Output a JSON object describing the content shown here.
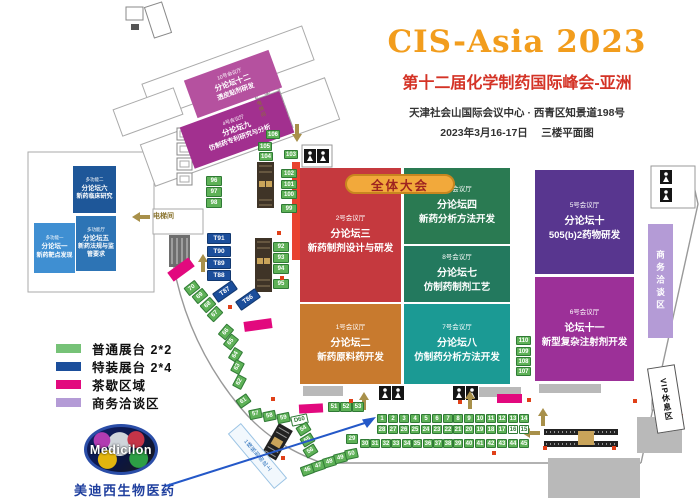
{
  "title": {
    "brand": "CIS-Asia 2023",
    "subtitle": "第十二届化学制药国际峰会-亚洲",
    "venue": "天津社会山国际会议中心 · 西青区知景道198号",
    "dateline": "2023年3月16-17日　 三楼平面图"
  },
  "banner": {
    "label": "全体大会"
  },
  "legend": {
    "items": [
      {
        "label": "普通展台 2*2",
        "color": "#76c277"
      },
      {
        "label": "特装展台 2*4",
        "color": "#1b4e9b"
      },
      {
        "label": "茶歇区域",
        "color": "#e2097e"
      },
      {
        "label": "商务洽谈区",
        "color": "#b49bd6"
      }
    ]
  },
  "areas": {
    "business": "商务洽谈区",
    "vip": "VIP休息区",
    "elevator": "电梯间",
    "registration": "1楼报到由此上"
  },
  "sponsor": {
    "name": "Medicilon",
    "cn_name": "美迪西生物医药"
  },
  "map": {
    "colors": {
      "booth_standard": "#5eb157",
      "booth_special": "#1b4e9b",
      "tea_break": "#e2097e",
      "business_area": "#b49bd6",
      "red_strip": "#e8432f"
    },
    "halls": [
      {
        "room": "2号会议厅",
        "forum": "分论坛三",
        "topic": "新药制剂设计与研发",
        "color": "#c5393e",
        "x": 300,
        "y": 168,
        "w": 101,
        "h": 134,
        "fs": "lg"
      },
      {
        "room": "1号会议厅",
        "forum": "分论坛二",
        "topic": "新药原料药开发",
        "color": "#c87a2e",
        "x": 300,
        "y": 304,
        "w": 101,
        "h": 80,
        "fs": "lg"
      },
      {
        "room": "3号会议厅",
        "forum": "分论坛四",
        "topic": "新药分析方法开发",
        "color": "#2a7a52",
        "x": 404,
        "y": 168,
        "w": 106,
        "h": 76,
        "fs": "lg"
      },
      {
        "room": "8号会议厅",
        "forum": "分论坛七",
        "topic": "仿制药制剂工艺",
        "color": "#23795e",
        "x": 404,
        "y": 246,
        "w": 106,
        "h": 56,
        "fs": "lg"
      },
      {
        "room": "7号会议厅",
        "forum": "分论坛八",
        "topic": "仿制药分析方法开发",
        "color": "#1b9a94",
        "x": 404,
        "y": 304,
        "w": 106,
        "h": 80,
        "fs": "lg"
      },
      {
        "room": "5号会议厅",
        "forum": "分论坛十",
        "topic": "505(b)2药物研发",
        "color": "#58368f",
        "x": 535,
        "y": 170,
        "w": 99,
        "h": 104,
        "fs": "lg"
      },
      {
        "room": "6号会议厅",
        "forum": "论坛十一",
        "topic": "新型复杂注射剂开发",
        "color": "#9c3098",
        "x": 535,
        "y": 277,
        "w": 99,
        "h": 104,
        "fs": "lg"
      },
      {
        "room": "多功能二",
        "forum": "分论坛六",
        "topic": "新药临床研究",
        "color": "#1e5799",
        "x": 73,
        "y": 166,
        "w": 43,
        "h": 47,
        "fs": "sm"
      },
      {
        "room": "多功能厅",
        "forum": "分论坛五",
        "topic": "新药法规与监管要求",
        "color": "#2d74b5",
        "x": 76,
        "y": 216,
        "w": 40,
        "h": 55,
        "fs": "sm"
      },
      {
        "room": "多功能一",
        "forum": "分论坛一",
        "topic": "新药靶点发现",
        "color": "#3f8fd2",
        "x": 34,
        "y": 223,
        "w": 41,
        "h": 50,
        "fs": "sm"
      },
      {
        "room": "10号会议厅",
        "forum": "分论坛十二",
        "topic": "透皮贴剂研发",
        "color": "#b5519f",
        "x": 188,
        "y": 64,
        "w": 90,
        "h": 40,
        "r": -20,
        "fs": "xs"
      },
      {
        "room": "4号会议厅",
        "forum": "分论坛九",
        "topic": "仿制药专利研究与分析",
        "color": "#a2308f",
        "x": 184,
        "y": 108,
        "w": 106,
        "h": 44,
        "r": -20,
        "fs": "xs"
      }
    ],
    "booths": [
      {
        "label": "106",
        "x": 266,
        "y": 130,
        "w": 14,
        "h": 9
      },
      {
        "label": "105",
        "x": 258,
        "y": 142,
        "w": 14,
        "h": 9
      },
      {
        "label": "104",
        "x": 259,
        "y": 152,
        "w": 14,
        "h": 9
      },
      {
        "label": "103",
        "x": 284,
        "y": 150,
        "w": 14,
        "h": 9
      },
      {
        "label": "96",
        "x": 206,
        "y": 176,
        "w": 16,
        "h": 10
      },
      {
        "label": "97",
        "x": 206,
        "y": 187,
        "w": 16,
        "h": 10
      },
      {
        "label": "98",
        "x": 206,
        "y": 198,
        "w": 16,
        "h": 10
      },
      {
        "label": "102",
        "x": 281,
        "y": 169,
        "w": 16,
        "h": 9
      },
      {
        "label": "101",
        "x": 281,
        "y": 180,
        "w": 16,
        "h": 9
      },
      {
        "label": "100",
        "x": 281,
        "y": 190,
        "w": 16,
        "h": 9
      },
      {
        "label": "99",
        "x": 281,
        "y": 204,
        "w": 16,
        "h": 9
      },
      {
        "label": "110",
        "x": 516,
        "y": 336,
        "w": 15,
        "h": 9
      },
      {
        "label": "109",
        "x": 516,
        "y": 347,
        "w": 15,
        "h": 9
      },
      {
        "label": "108",
        "x": 516,
        "y": 357,
        "w": 15,
        "h": 9
      },
      {
        "label": "107",
        "x": 516,
        "y": 367,
        "w": 15,
        "h": 9
      },
      {
        "label": "T91",
        "x": 207,
        "y": 233,
        "w": 24,
        "h": 11,
        "k": "sp"
      },
      {
        "label": "T90",
        "x": 207,
        "y": 246,
        "w": 24,
        "h": 11,
        "k": "sp"
      },
      {
        "label": "T89",
        "x": 207,
        "y": 258,
        "w": 24,
        "h": 11,
        "k": "sp"
      },
      {
        "label": "T88",
        "x": 207,
        "y": 270,
        "w": 24,
        "h": 11,
        "k": "sp"
      },
      {
        "label": "T87",
        "x": 213,
        "y": 286,
        "w": 24,
        "h": 11,
        "r": -35,
        "k": "sp"
      },
      {
        "label": "T86",
        "x": 236,
        "y": 294,
        "w": 24,
        "h": 11,
        "r": -35,
        "k": "sp"
      },
      {
        "label": "92",
        "x": 273,
        "y": 242,
        "w": 16,
        "h": 10
      },
      {
        "label": "93",
        "x": 273,
        "y": 253,
        "w": 16,
        "h": 10
      },
      {
        "label": "94",
        "x": 273,
        "y": 264,
        "w": 16,
        "h": 10
      },
      {
        "label": "95",
        "x": 273,
        "y": 279,
        "w": 16,
        "h": 10
      },
      {
        "label": "70",
        "x": 185,
        "y": 283,
        "w": 14,
        "h": 10,
        "r": -38
      },
      {
        "label": "69",
        "x": 193,
        "y": 291,
        "w": 14,
        "h": 10,
        "r": -40
      },
      {
        "label": "68",
        "x": 201,
        "y": 300,
        "w": 14,
        "h": 10,
        "r": -42
      },
      {
        "label": "67",
        "x": 208,
        "y": 309,
        "w": 14,
        "h": 10,
        "r": -45
      },
      {
        "label": "66",
        "x": 219,
        "y": 327,
        "w": 14,
        "h": 10,
        "r": -50
      },
      {
        "label": "65",
        "x": 224,
        "y": 337,
        "w": 14,
        "h": 10,
        "r": -52
      },
      {
        "label": "64",
        "x": 229,
        "y": 350,
        "w": 13,
        "h": 10,
        "r": -58
      },
      {
        "label": "63",
        "x": 231,
        "y": 362,
        "w": 13,
        "h": 10,
        "r": -62
      },
      {
        "label": "62",
        "x": 233,
        "y": 377,
        "w": 13,
        "h": 10,
        "r": -62
      },
      {
        "label": "61",
        "x": 237,
        "y": 396,
        "w": 13,
        "h": 10,
        "r": -35
      },
      {
        "label": "57",
        "x": 249,
        "y": 409,
        "w": 13,
        "h": 10,
        "r": -12
      },
      {
        "label": "58",
        "x": 263,
        "y": 411,
        "w": 13,
        "h": 10,
        "r": -12
      },
      {
        "label": "59",
        "x": 277,
        "y": 413,
        "w": 13,
        "h": 10,
        "r": -12
      },
      {
        "label": "D60",
        "x": 291,
        "y": 415,
        "w": 17,
        "h": 10,
        "r": -12,
        "k": "out"
      },
      {
        "label": "54",
        "x": 297,
        "y": 424,
        "w": 13,
        "h": 10,
        "r": -32
      },
      {
        "label": "55",
        "x": 301,
        "y": 435,
        "w": 13,
        "h": 10,
        "r": -32
      },
      {
        "label": "56",
        "x": 304,
        "y": 446,
        "w": 13,
        "h": 10,
        "r": -32
      },
      {
        "label": "46",
        "x": 301,
        "y": 465,
        "w": 13,
        "h": 10,
        "r": -20
      },
      {
        "label": "47",
        "x": 312,
        "y": 461,
        "w": 13,
        "h": 10,
        "r": -18
      },
      {
        "label": "48",
        "x": 323,
        "y": 457,
        "w": 13,
        "h": 10,
        "r": -16
      },
      {
        "label": "49",
        "x": 334,
        "y": 453,
        "w": 13,
        "h": 10,
        "r": -14
      },
      {
        "label": "50",
        "x": 345,
        "y": 449,
        "w": 13,
        "h": 10,
        "r": -12
      },
      {
        "label": "51",
        "x": 328,
        "y": 402,
        "w": 12,
        "h": 10
      },
      {
        "label": "52",
        "x": 340,
        "y": 402,
        "w": 12,
        "h": 10
      },
      {
        "label": "53",
        "x": 352,
        "y": 402,
        "w": 12,
        "h": 10
      },
      {
        "label": "29",
        "x": 346,
        "y": 434,
        "w": 12,
        "h": 10
      },
      {
        "label": "1",
        "x": 377,
        "y": 414
      },
      {
        "label": "2",
        "x": 388,
        "y": 414
      },
      {
        "label": "3",
        "x": 399,
        "y": 414
      },
      {
        "label": "4",
        "x": 410,
        "y": 414
      },
      {
        "label": "5",
        "x": 421,
        "y": 414
      },
      {
        "label": "6",
        "x": 432,
        "y": 414
      },
      {
        "label": "7",
        "x": 443,
        "y": 414
      },
      {
        "label": "8",
        "x": 453,
        "y": 414
      },
      {
        "label": "9",
        "x": 464,
        "y": 414
      },
      {
        "label": "10",
        "x": 475,
        "y": 414
      },
      {
        "label": "11",
        "x": 486,
        "y": 414
      },
      {
        "label": "12",
        "x": 497,
        "y": 414
      },
      {
        "label": "13",
        "x": 508,
        "y": 414
      },
      {
        "label": "14",
        "x": 519,
        "y": 414
      },
      {
        "label": "28",
        "x": 377,
        "y": 425
      },
      {
        "label": "27",
        "x": 388,
        "y": 425
      },
      {
        "label": "26",
        "x": 399,
        "y": 425
      },
      {
        "label": "25",
        "x": 410,
        "y": 425
      },
      {
        "label": "24",
        "x": 421,
        "y": 425
      },
      {
        "label": "23",
        "x": 432,
        "y": 425
      },
      {
        "label": "22",
        "x": 443,
        "y": 425
      },
      {
        "label": "21",
        "x": 453,
        "y": 425
      },
      {
        "label": "20",
        "x": 464,
        "y": 425
      },
      {
        "label": "19",
        "x": 475,
        "y": 425
      },
      {
        "label": "18",
        "x": 486,
        "y": 425
      },
      {
        "label": "17",
        "x": 497,
        "y": 425
      },
      {
        "label": "16",
        "x": 508,
        "y": 425,
        "k": "out"
      },
      {
        "label": "15",
        "x": 519,
        "y": 425,
        "k": "out"
      },
      {
        "label": "30",
        "x": 360,
        "y": 439
      },
      {
        "label": "31",
        "x": 370,
        "y": 439
      },
      {
        "label": "32",
        "x": 381,
        "y": 439
      },
      {
        "label": "33",
        "x": 391,
        "y": 439
      },
      {
        "label": "34",
        "x": 402,
        "y": 439
      },
      {
        "label": "35",
        "x": 412,
        "y": 439
      },
      {
        "label": "36",
        "x": 423,
        "y": 439
      },
      {
        "label": "37",
        "x": 433,
        "y": 439
      },
      {
        "label": "38",
        "x": 443,
        "y": 439
      },
      {
        "label": "39",
        "x": 453,
        "y": 439
      },
      {
        "label": "40",
        "x": 464,
        "y": 439
      },
      {
        "label": "41",
        "x": 475,
        "y": 439
      },
      {
        "label": "42",
        "x": 486,
        "y": 439
      },
      {
        "label": "43",
        "x": 497,
        "y": 439
      },
      {
        "label": "44",
        "x": 508,
        "y": 439
      },
      {
        "label": "45",
        "x": 519,
        "y": 439
      }
    ],
    "pink_bars": [
      [
        168,
        264,
        26,
        11,
        -36
      ],
      [
        244,
        320,
        28,
        10,
        -8
      ],
      [
        299,
        404,
        24,
        9,
        -3
      ],
      [
        497,
        394,
        25,
        9,
        0
      ]
    ],
    "gray_blocks": [
      [
        303,
        386,
        40,
        10
      ],
      [
        479,
        387,
        42,
        10
      ],
      [
        539,
        384,
        62,
        9
      ],
      [
        637,
        417,
        45,
        36
      ],
      [
        548,
        458,
        92,
        40
      ]
    ],
    "red_dots": [
      [
        271,
        397
      ],
      [
        349,
        399
      ],
      [
        458,
        400
      ],
      [
        527,
        398
      ],
      [
        633,
        399
      ],
      [
        679,
        414
      ],
      [
        281,
        456
      ],
      [
        543,
        446
      ],
      [
        612,
        446
      ],
      [
        492,
        451
      ],
      [
        277,
        231
      ],
      [
        280,
        276
      ],
      [
        228,
        305
      ]
    ]
  }
}
